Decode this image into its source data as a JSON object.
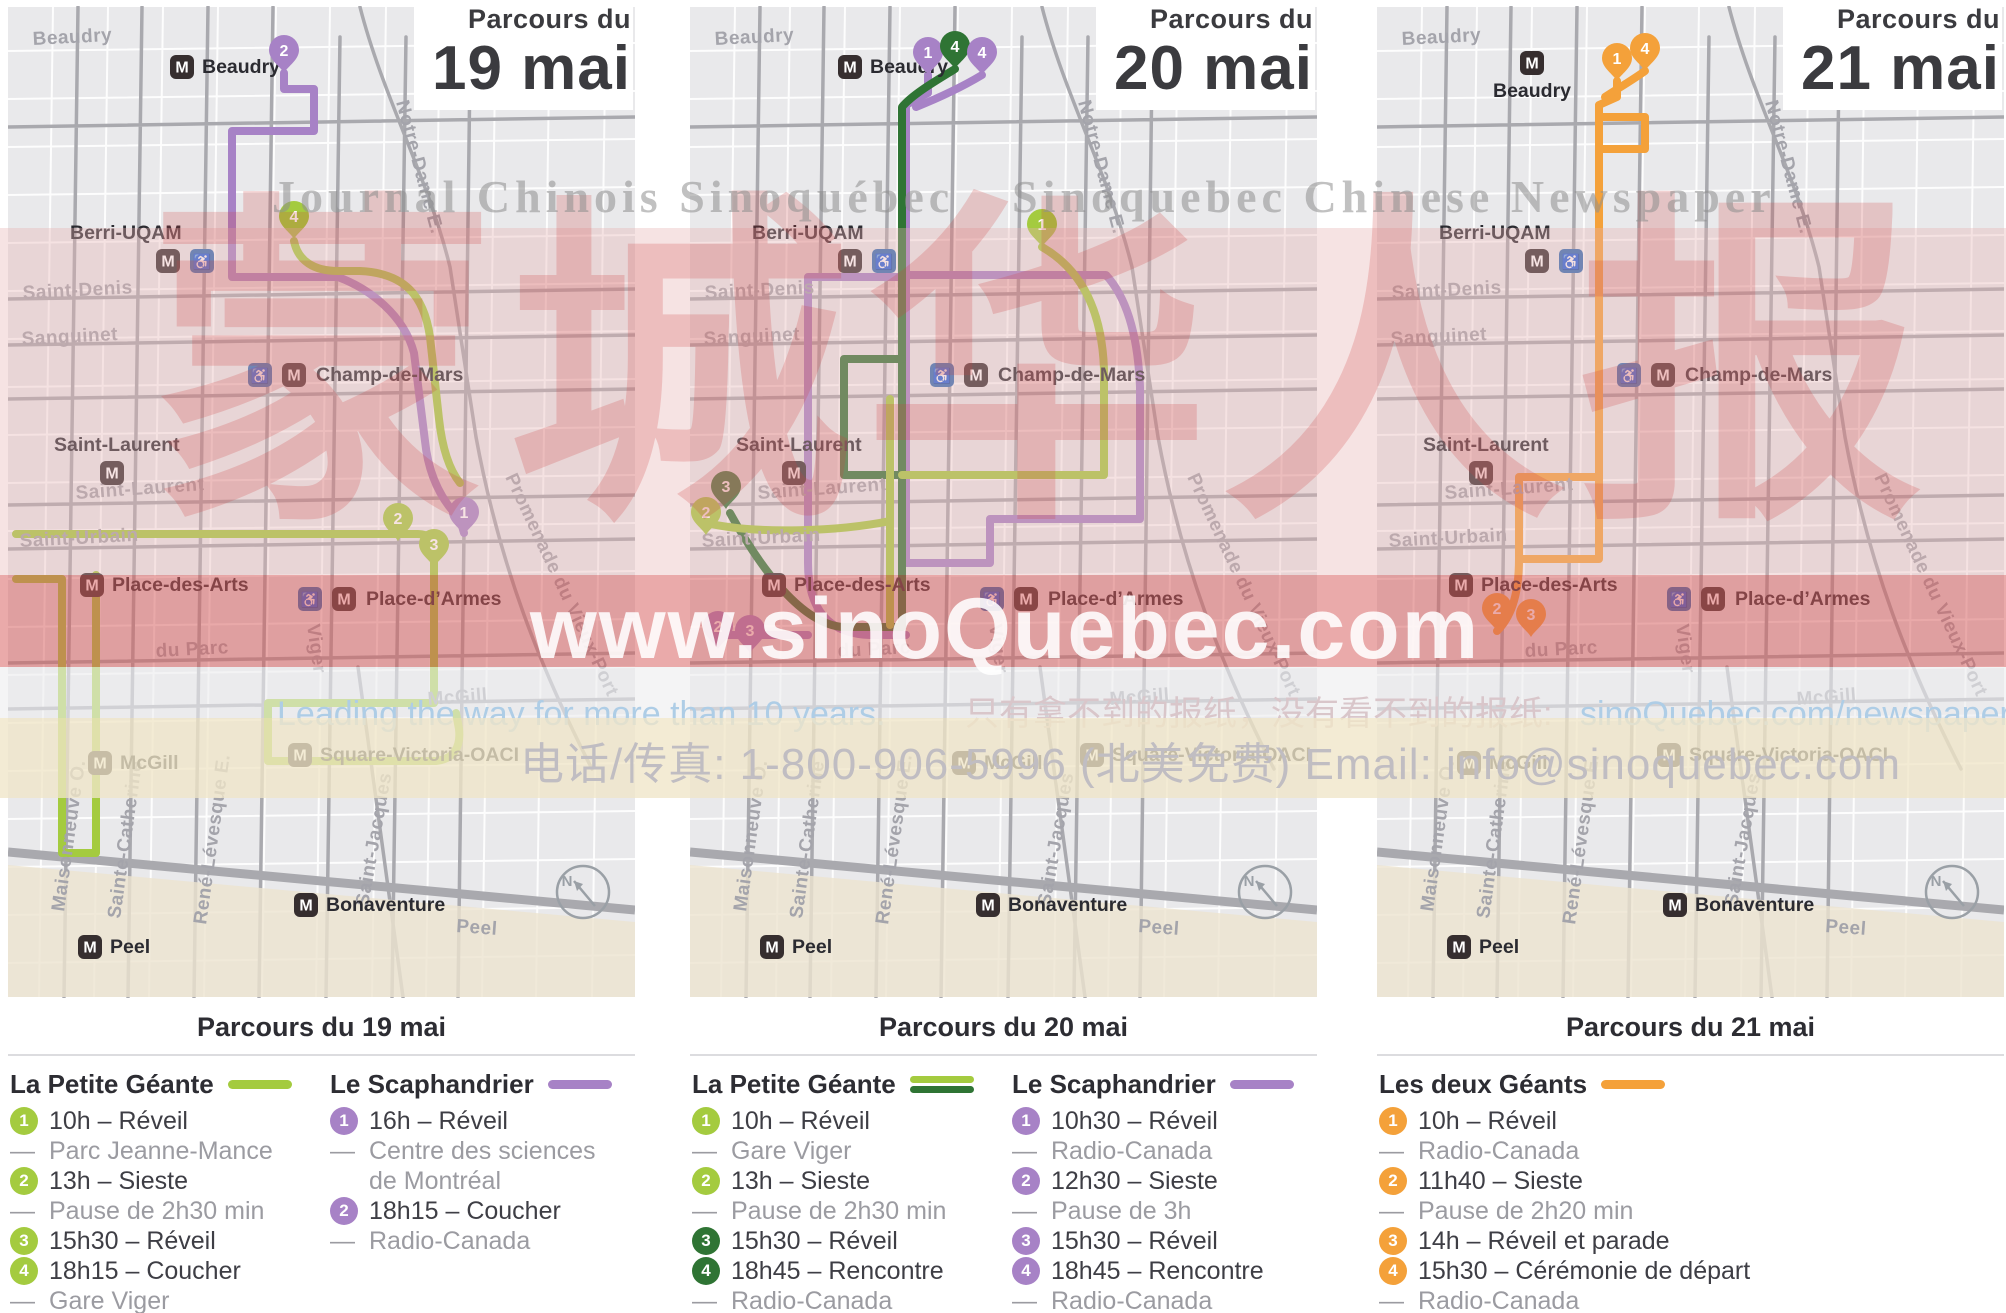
{
  "icons": {
    "metro_m": "M",
    "wheelchair": "♿",
    "compass_n": "N"
  },
  "colors": {
    "light_green": "#a4cb3f",
    "dark_green": "#2f7434",
    "purple": "#a782c6",
    "orange": "#f4a13a",
    "map_background": "#e9e9eb",
    "street_gray": "#a9a9ae",
    "metro_badge": "#362e2f",
    "wheelchair_badge": "#2f6cb4",
    "header_text": "#3b3b3f",
    "watermark_red": "#d04040"
  },
  "panels": [
    {
      "header_line1": "Parcours du",
      "header_line2": "19 mai",
      "caption": "Parcours du 19 mai"
    },
    {
      "header_line1": "Parcours du",
      "header_line2": "20 mai",
      "caption": "Parcours du 20 mai"
    },
    {
      "header_line1": "Parcours du",
      "header_line2": "21 mai",
      "caption": "Parcours du 21 mai"
    }
  ],
  "map_labels": {
    "stations": {
      "beaudry": "Beaudry",
      "berri": "Berri-UQAM",
      "champ": "Champ-de-Mars",
      "saint_laurent": "Saint-Laurent",
      "pda": "Place-des-Arts",
      "pdarmes": "Place-d’Armes",
      "mcgill": "McGill",
      "svo": "Square-Victoria-OACI",
      "bonaventure": "Bonaventure",
      "peel": "Peel"
    },
    "streets": {
      "beaudry": "Beaudry",
      "notre_dame": "Notre-Dame E.",
      "saint_denis": "Saint-Denis",
      "sanguinet": "Sanguinet",
      "saint_laurent": "Saint-Laurent",
      "saint_urbain": "Saint-Urbain",
      "du_parc": "du Parc",
      "viger": "Viger",
      "mcgill": "McGill",
      "maisonneuve": "Maisonneuve O.",
      "sainte_catherine": "Sainte-Catherine",
      "rene_levesque": "René-Lévesque E.",
      "saint_jacques": "Saint-Jacques",
      "peel": "Peel",
      "promenade": "Promenade du Vieux-Port"
    }
  },
  "maps": [
    {
      "pins": [
        {
          "n": "2",
          "color": "#a782c6"
        },
        {
          "n": "4",
          "color": "#a4cb3f"
        },
        {
          "n": "2",
          "color": "#a4cb3f"
        },
        {
          "n": "3",
          "color": "#a4cb3f"
        },
        {
          "n": "1",
          "color": "#a782c6"
        }
      ]
    },
    {
      "pins": [
        {
          "n": "1",
          "color": "#a782c6"
        },
        {
          "n": "4",
          "color": "#2f7434"
        },
        {
          "n": "4",
          "color": "#a782c6"
        },
        {
          "n": "1",
          "color": "#a4cb3f"
        },
        {
          "n": "3",
          "color": "#2f7434"
        },
        {
          "n": "2",
          "color": "#a4cb3f"
        },
        {
          "n": "2",
          "color": "#a782c6"
        },
        {
          "n": "3",
          "color": "#a782c6"
        }
      ]
    },
    {
      "pins": [
        {
          "n": "1",
          "color": "#f4a13a"
        },
        {
          "n": "4",
          "color": "#f4a13a"
        },
        {
          "n": "2",
          "color": "#f4a13a"
        },
        {
          "n": "3",
          "color": "#f4a13a"
        }
      ]
    }
  ],
  "legends": [
    {
      "columns": [
        {
          "title": "La Petite Géante",
          "items": [
            {
              "marker": "1",
              "text": "10h – Réveil"
            },
            {
              "marker": "—",
              "text": "Parc Jeanne-Mance"
            },
            {
              "marker": "2",
              "text": "13h – Sieste"
            },
            {
              "marker": "—",
              "text": "Pause de 2h30 min"
            },
            {
              "marker": "3",
              "text": "15h30 – Réveil"
            },
            {
              "marker": "4",
              "text": "18h15 – Coucher"
            },
            {
              "marker": "—",
              "text": "Gare Viger"
            }
          ]
        },
        {
          "title": "Le Scaphandrier",
          "items": [
            {
              "marker": "1",
              "text": "16h – Réveil"
            },
            {
              "marker": "—",
              "text": "Centre des sciences"
            },
            {
              "marker": "",
              "text": "de Montréal"
            },
            {
              "marker": "2",
              "text": "18h15 – Coucher"
            },
            {
              "marker": "—",
              "text": "Radio-Canada"
            }
          ]
        }
      ]
    },
    {
      "columns": [
        {
          "title": "La Petite Géante",
          "items": [
            {
              "marker": "1",
              "text": "10h – Réveil"
            },
            {
              "marker": "—",
              "text": "Gare Viger"
            },
            {
              "marker": "2",
              "text": "13h – Sieste"
            },
            {
              "marker": "—",
              "text": "Pause de 2h30 min"
            },
            {
              "marker": "3",
              "text": "15h30 – Réveil"
            },
            {
              "marker": "4",
              "text": "18h45 – Rencontre"
            },
            {
              "marker": "—",
              "text": "Radio-Canada"
            }
          ]
        },
        {
          "title": "Le Scaphandrier",
          "items": [
            {
              "marker": "1",
              "text": "10h30 – Réveil"
            },
            {
              "marker": "—",
              "text": "Radio-Canada"
            },
            {
              "marker": "2",
              "text": "12h30 – Sieste"
            },
            {
              "marker": "—",
              "text": "Pause de 3h"
            },
            {
              "marker": "3",
              "text": "15h30 – Réveil"
            },
            {
              "marker": "4",
              "text": "18h45 – Rencontre"
            },
            {
              "marker": "—",
              "text": "Radio-Canada"
            }
          ]
        }
      ]
    },
    {
      "columns": [
        {
          "title": "Les deux Géants",
          "items": [
            {
              "marker": "1",
              "text": "10h – Réveil"
            },
            {
              "marker": "—",
              "text": "Radio-Canada"
            },
            {
              "marker": "2",
              "text": "11h40 – Sieste"
            },
            {
              "marker": "—",
              "text": "Pause de 2h20 min"
            },
            {
              "marker": "3",
              "text": "14h – Réveil et parade"
            },
            {
              "marker": "4",
              "text": "15h30 – Cérémonie de départ"
            },
            {
              "marker": "—",
              "text": "Radio-Canada"
            }
          ]
        }
      ]
    }
  ],
  "watermark": {
    "serif_left": "Journal Chinois Sinoquébec",
    "serif_right": "Sinoquebec Chinese Newspaper",
    "hanzi": "蒙城华人报",
    "url_large": "www.sinoQuebec.com",
    "tagline_en": "Leading the way for more than 10 years.",
    "tagline_zh": "只有拿不到的报纸，没有看不到的报纸:",
    "tagline_link": "sinoQuebec.com/newspaper",
    "contact": "电话/传真: 1-800-906-5996 (北美免费)  Email: info@sinoquebec.com"
  }
}
